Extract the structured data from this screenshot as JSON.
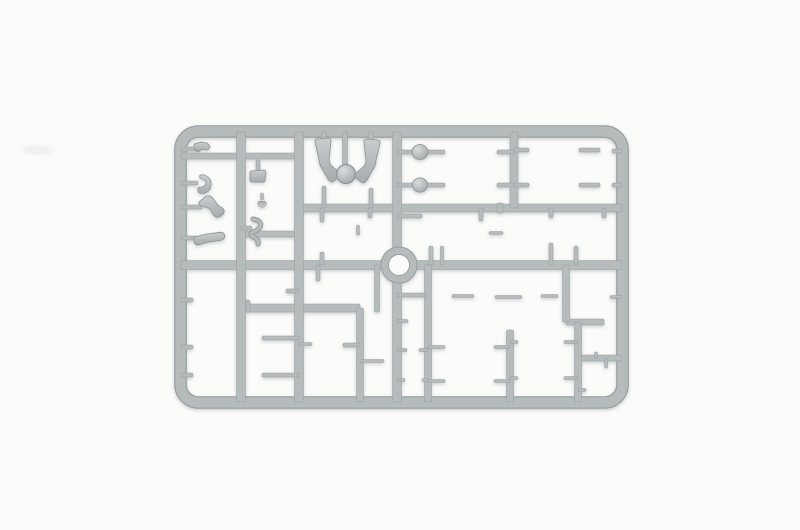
{
  "scene": {
    "description": "Photograph of a gray injection-molded plastic model sprue holding small soldier-figure parts (prone figures, torsos, heads, helmets, arms, legs, equipment) on a plain white background",
    "background": "#fbfbfa",
    "plastic": "#b6bbbc",
    "plastic_dark": "#979da0",
    "plastic_stroke": "#8d9396",
    "plastic_light": "#d6dada",
    "part_light": "#c9cdce",
    "part_mid": "#a6abad",
    "head_light": "#d8dcdc",
    "head_dark": "#9fa4a7",
    "shadow": "#5f666a",
    "smudge_color": "#eae8e4"
  },
  "sprue": {
    "frame": {
      "cx": 180.5,
      "cy": 131.5,
      "cw": 442,
      "ch": 271,
      "rail": 11,
      "radius": 18
    },
    "ring": {
      "cx": 399,
      "cy": 265,
      "outer_r": 18,
      "inner_r": 10.5
    },
    "runners": [
      [
        181,
        265,
        622,
        265,
        9
      ],
      [
        300,
        208,
        622,
        208,
        8
      ],
      [
        181,
        156,
        299,
        156,
        6
      ],
      [
        241,
        234,
        299,
        234,
        6
      ],
      [
        241,
        308,
        360,
        308,
        8
      ],
      [
        566,
        322,
        604,
        322,
        6
      ],
      [
        578,
        358,
        622,
        358,
        6
      ],
      [
        241,
        132,
        241,
        402,
        9
      ],
      [
        299,
        132,
        299,
        402,
        9
      ],
      [
        397,
        132,
        397,
        402,
        9
      ],
      [
        514,
        132,
        514,
        208,
        8
      ],
      [
        510,
        330,
        510,
        402,
        7
      ],
      [
        566,
        265,
        566,
        322,
        7
      ],
      [
        578,
        322,
        578,
        402,
        7
      ],
      [
        360,
        308,
        360,
        402,
        7
      ],
      [
        428,
        265,
        428,
        402,
        7
      ],
      [
        181,
        149,
        200,
        149,
        4
      ],
      [
        181,
        183,
        198,
        183,
        4
      ],
      [
        181,
        207,
        202,
        207,
        4
      ],
      [
        181,
        238,
        198,
        238,
        4
      ],
      [
        258,
        160,
        258,
        171,
        4
      ],
      [
        262,
        193,
        262,
        200,
        3
      ],
      [
        241,
        228,
        252,
        228,
        4
      ],
      [
        324,
        132,
        324,
        146,
        5
      ],
      [
        345,
        132,
        345,
        168,
        5
      ],
      [
        371,
        132,
        371,
        145,
        5
      ],
      [
        324,
        186,
        324,
        208,
        4
      ],
      [
        371,
        188,
        371,
        208,
        4
      ],
      [
        397,
        152,
        414,
        152,
        4
      ],
      [
        397,
        185,
        414,
        185,
        4
      ],
      [
        426,
        152,
        445,
        152,
        4
      ],
      [
        426,
        185,
        445,
        185,
        4
      ],
      [
        497,
        152,
        514,
        152,
        4
      ],
      [
        497,
        185,
        514,
        185,
        4
      ],
      [
        514,
        150,
        529,
        150,
        4
      ],
      [
        514,
        185,
        529,
        185,
        4
      ],
      [
        579,
        150,
        600,
        150,
        4
      ],
      [
        579,
        185,
        600,
        185,
        4
      ],
      [
        612,
        151,
        622,
        151,
        4
      ],
      [
        612,
        185,
        622,
        185,
        4
      ],
      [
        322,
        208,
        322,
        222,
        4
      ],
      [
        322,
        252,
        322,
        265,
        4
      ],
      [
        370,
        208,
        370,
        218,
        4
      ],
      [
        358,
        225,
        358,
        235,
        3
      ],
      [
        397,
        216,
        422,
        216,
        4
      ],
      [
        431,
        246,
        431,
        265,
        4
      ],
      [
        442,
        246,
        442,
        265,
        3
      ],
      [
        481,
        208,
        481,
        221,
        4
      ],
      [
        489,
        233,
        503,
        233,
        3
      ],
      [
        500,
        203,
        500,
        213,
        6
      ],
      [
        551,
        208,
        551,
        218,
        4
      ],
      [
        551,
        243,
        551,
        265,
        4
      ],
      [
        576,
        246,
        576,
        265,
        4
      ],
      [
        604,
        208,
        604,
        218,
        4
      ],
      [
        181,
        300,
        193,
        300,
        4
      ],
      [
        181,
        347,
        193,
        347,
        4
      ],
      [
        181,
        375,
        193,
        375,
        4
      ],
      [
        286,
        291,
        299,
        291,
        4
      ],
      [
        248,
        300,
        248,
        312,
        4
      ],
      [
        262,
        338,
        299,
        338,
        4
      ],
      [
        262,
        375,
        299,
        375,
        4
      ],
      [
        318,
        265,
        318,
        281,
        4
      ],
      [
        299,
        344,
        312,
        344,
        3
      ],
      [
        343,
        345,
        360,
        345,
        4
      ],
      [
        377,
        265,
        377,
        312,
        5
      ],
      [
        360,
        361,
        384,
        361,
        3
      ],
      [
        397,
        295,
        426,
        295,
        4
      ],
      [
        452,
        296,
        474,
        296,
        3
      ],
      [
        495,
        297,
        522,
        297,
        3
      ],
      [
        541,
        296,
        558,
        296,
        3
      ],
      [
        610,
        297,
        622,
        297,
        3
      ],
      [
        397,
        321,
        408,
        321,
        3
      ],
      [
        397,
        350,
        407,
        350,
        3
      ],
      [
        419,
        350,
        428,
        350,
        3
      ],
      [
        397,
        380,
        405,
        380,
        3
      ],
      [
        422,
        380,
        428,
        380,
        3
      ],
      [
        428,
        347,
        445,
        347,
        3
      ],
      [
        494,
        347,
        510,
        347,
        3
      ],
      [
        428,
        381,
        445,
        381,
        3
      ],
      [
        494,
        381,
        510,
        381,
        3
      ],
      [
        510,
        342,
        518,
        342,
        3
      ],
      [
        564,
        342,
        578,
        342,
        3
      ],
      [
        510,
        378,
        518,
        378,
        3
      ],
      [
        564,
        378,
        578,
        378,
        3
      ],
      [
        596,
        352,
        596,
        358,
        3
      ],
      [
        606,
        358,
        606,
        368,
        3
      ],
      [
        578,
        390,
        586,
        390,
        3
      ]
    ],
    "parts": [
      {
        "name": "bracket",
        "shape": "bracket",
        "x": 202,
        "y": 148
      },
      {
        "name": "equipment-box",
        "shape": "box",
        "x": 258,
        "y": 176
      },
      {
        "name": "crescent-arm",
        "shape": "crescent",
        "x": 203,
        "y": 184,
        "rot": 15,
        "s": 0.9
      },
      {
        "name": "bent-arm",
        "shape": "armBent",
        "x": 211,
        "y": 207,
        "rot": -10
      },
      {
        "name": "straight-arm",
        "shape": "armLong",
        "x": 210,
        "y": 239,
        "rot": -4
      },
      {
        "name": "small-knob",
        "shape": "cap",
        "x": 262,
        "y": 204,
        "rot": 180,
        "s": 0.55
      },
      {
        "name": "rifle-sling",
        "shape": "squiggle",
        "x": 257,
        "y": 232
      },
      {
        "name": "kneeling-leg",
        "shape": "legBent",
        "x": 324,
        "y": 167
      },
      {
        "name": "head",
        "shape": "head",
        "x": 346,
        "y": 174,
        "s": 1.45
      },
      {
        "name": "kneeling-leg",
        "shape": "legBent",
        "x": 371,
        "y": 168,
        "flip": true
      },
      {
        "name": "disc-base",
        "shape": "disc",
        "x": 420,
        "y": 152
      },
      {
        "name": "disc-base",
        "shape": "disc",
        "x": 420,
        "y": 185,
        "s": 0.95
      },
      {
        "name": "prone-figure",
        "shape": "lyingFigure",
        "x": 471,
        "y": 152,
        "s": 1.05
      },
      {
        "name": "prone-figure",
        "shape": "lyingFigure",
        "x": 471,
        "y": 186,
        "rot": 2,
        "s": 1.05
      },
      {
        "name": "prone-figure",
        "shape": "lyingFigure",
        "x": 553,
        "y": 150,
        "rot": -2,
        "flip": true
      },
      {
        "name": "prone-figure",
        "shape": "lyingFigure",
        "x": 553,
        "y": 186,
        "flip": true
      },
      {
        "name": "helmet",
        "shape": "helmet",
        "x": 606,
        "y": 151
      },
      {
        "name": "helmet",
        "shape": "helmet",
        "x": 606,
        "y": 185
      },
      {
        "name": "standing-figure",
        "shape": "torsoFig",
        "x": 322,
        "y": 237,
        "s": 0.95
      },
      {
        "name": "elbow-joint",
        "shape": "pipe",
        "x": 374,
        "y": 223,
        "rot": 100,
        "s": 0.9
      },
      {
        "name": "bent-arm",
        "shape": "armBent",
        "x": 359,
        "y": 242,
        "rot": 85
      },
      {
        "name": "bent-arm",
        "shape": "armBent",
        "x": 426,
        "y": 209,
        "rot": 75,
        "flip": true
      },
      {
        "name": "straight-arm",
        "shape": "armLong",
        "x": 440,
        "y": 241,
        "rot": 3,
        "s": 0.95
      },
      {
        "name": "standing-figure",
        "shape": "torsoFig",
        "x": 481,
        "y": 234,
        "s": 0.92
      },
      {
        "name": "seated-figure",
        "shape": "torsoOnly",
        "x": 551,
        "y": 230
      },
      {
        "name": "field-cap",
        "shape": "cap",
        "x": 551,
        "y": 215,
        "s": 0.75
      },
      {
        "name": "curved-strap",
        "shape": "crescent",
        "x": 575,
        "y": 233,
        "rot": -20,
        "s": 0.85
      },
      {
        "name": "curved-strap",
        "shape": "crescent",
        "x": 586,
        "y": 240,
        "rot": 140,
        "s": 0.7
      },
      {
        "name": "bent-arm",
        "shape": "armBent",
        "x": 603,
        "y": 207,
        "rot": -30,
        "flip": true
      },
      {
        "name": "boot-leg",
        "shape": "legBent",
        "x": 196,
        "y": 300,
        "rot": 8,
        "s": 0.82
      },
      {
        "name": "boot-leg",
        "shape": "legBent",
        "x": 197,
        "y": 366,
        "rot": 3,
        "s": 1.2
      },
      {
        "name": "greatcoat-figure",
        "shape": "greatcoat",
        "x": 258,
        "y": 293,
        "s": 1.05
      },
      {
        "name": "head",
        "shape": "head",
        "x": 284,
        "y": 291,
        "s": 0.8
      },
      {
        "name": "standing-figure",
        "shape": "torsoFig",
        "x": 318,
        "y": 300,
        "s": 1.05
      },
      {
        "name": "marching-legs",
        "shape": "legsWalking",
        "x": 242,
        "y": 338
      },
      {
        "name": "marching-legs",
        "shape": "legsWalking",
        "x": 242,
        "y": 375,
        "rot": 2
      },
      {
        "name": "sitting-legs",
        "shape": "legsSitting",
        "x": 326,
        "y": 344
      },
      {
        "name": "marching-legs",
        "shape": "legsWalking",
        "x": 334,
        "y": 373,
        "flip": true
      },
      {
        "name": "field-cap",
        "shape": "cap",
        "x": 366,
        "y": 290,
        "rot": -90
      },
      {
        "name": "field-cap",
        "shape": "cap",
        "x": 366,
        "y": 308,
        "rot": -90
      },
      {
        "name": "bent-arm",
        "shape": "armBent",
        "x": 364,
        "y": 333,
        "rot": 120
      },
      {
        "name": "boot-leg",
        "shape": "legBent",
        "x": 391,
        "y": 372,
        "rot": 12,
        "s": 0.75,
        "flip": true
      },
      {
        "name": "bent-arm",
        "shape": "armBent",
        "x": 440,
        "y": 295,
        "rot": 40
      },
      {
        "name": "torso",
        "shape": "torsoOnly",
        "x": 485,
        "y": 296,
        "s": 0.9
      },
      {
        "name": "head",
        "shape": "head",
        "x": 485,
        "y": 314,
        "s": 0.9
      },
      {
        "name": "torso",
        "shape": "torsoOnly",
        "x": 532,
        "y": 296,
        "rot": 3,
        "s": 0.9
      },
      {
        "name": "head",
        "shape": "head",
        "x": 532,
        "y": 313,
        "s": 0.85
      },
      {
        "name": "bent-arm",
        "shape": "armBent",
        "x": 572,
        "y": 297,
        "rot": -50,
        "s": 0.9
      },
      {
        "name": "bent-arm",
        "shape": "armBent",
        "x": 603,
        "y": 297,
        "rot": 150,
        "s": 0.9
      },
      {
        "name": "straight-arm",
        "shape": "armLong",
        "x": 416,
        "y": 321,
        "rot": 70,
        "s": 0.75
      },
      {
        "name": "head",
        "shape": "head",
        "x": 413,
        "y": 350,
        "s": 0.95
      },
      {
        "name": "helmet",
        "shape": "helmet",
        "x": 414,
        "y": 380,
        "s": 0.95
      },
      {
        "name": "prone-legs",
        "shape": "lyingFigure",
        "x": 470,
        "y": 347,
        "s": 0.92
      },
      {
        "name": "prone-legs",
        "shape": "lyingFigure",
        "x": 470,
        "y": 381,
        "rot": 2,
        "s": 0.92
      },
      {
        "name": "prone-legs",
        "shape": "lyingFigure",
        "x": 541,
        "y": 342,
        "flip": true,
        "s": 0.88
      },
      {
        "name": "prone-legs",
        "shape": "lyingFigure",
        "x": 541,
        "y": 378,
        "rot": -2,
        "flip": true,
        "s": 0.88
      },
      {
        "name": "head",
        "shape": "head",
        "x": 609,
        "y": 322,
        "s": 0.8
      },
      {
        "name": "field-cap",
        "shape": "cap",
        "x": 596,
        "y": 345,
        "rot": -80,
        "s": 0.85
      },
      {
        "name": "helmet",
        "shape": "helmet",
        "x": 606,
        "y": 375,
        "s": 0.9
      },
      {
        "name": "strap-hook",
        "shape": "squiggle",
        "x": 590,
        "y": 392,
        "s": 0.65
      }
    ],
    "smudge": {
      "x": 38,
      "y": 150,
      "rx": 16,
      "ry": 5
    }
  }
}
